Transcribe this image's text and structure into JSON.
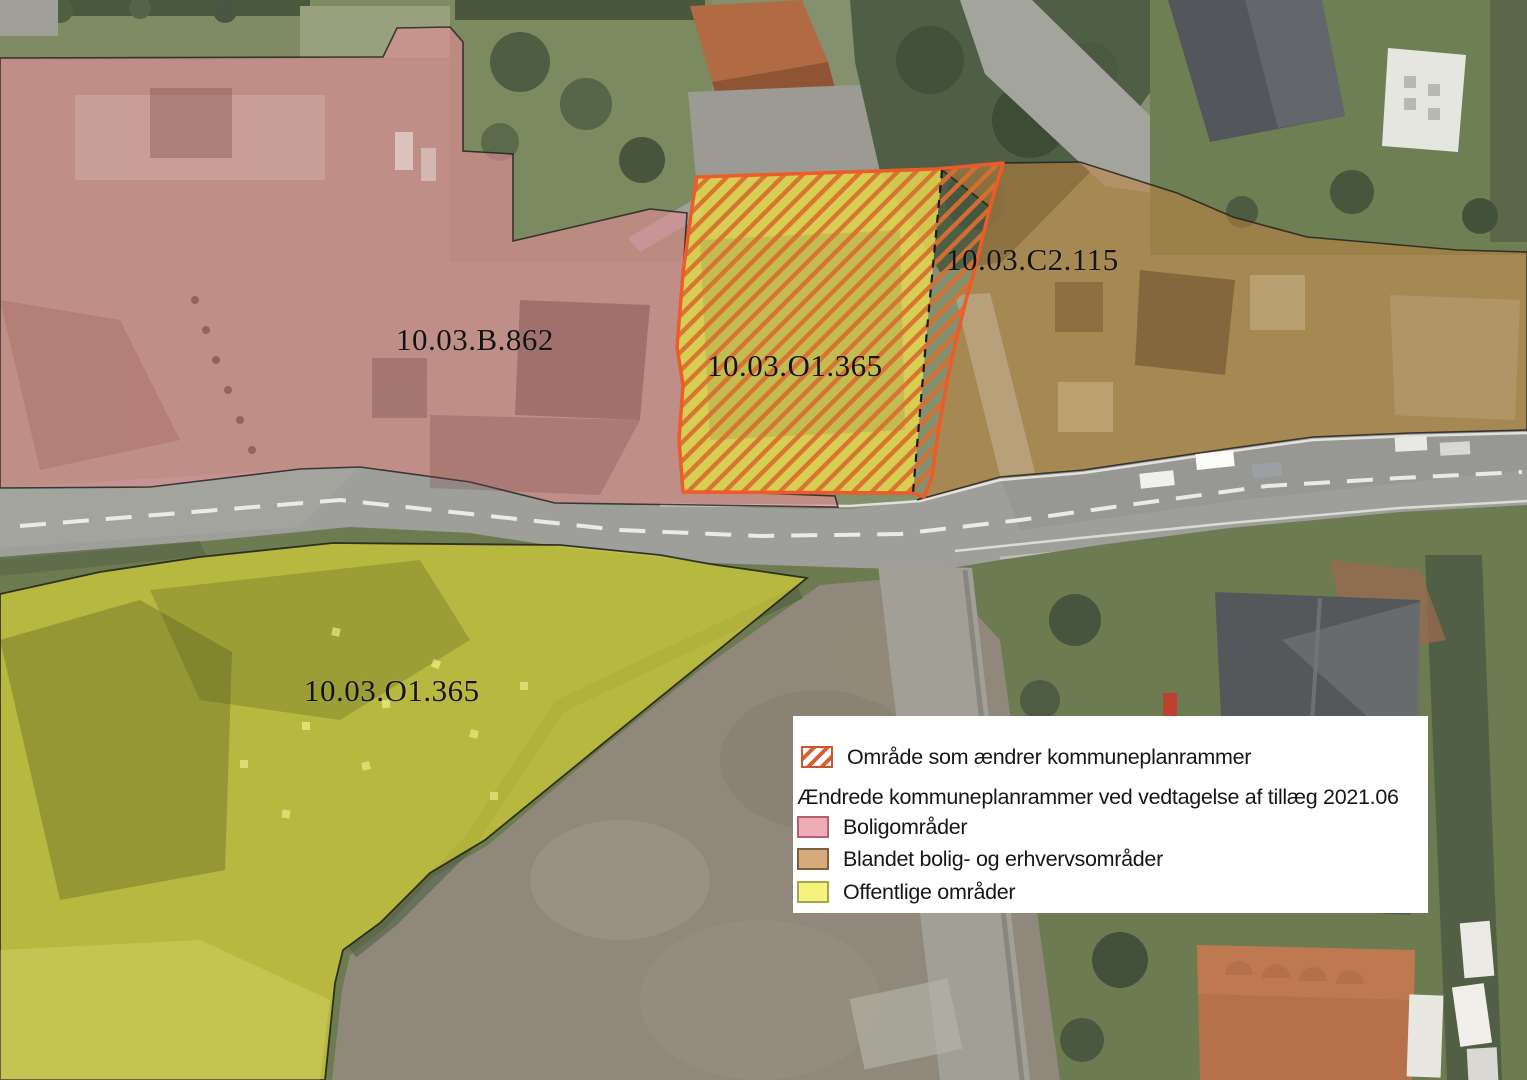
{
  "map_labels": {
    "zone_residential": "10.03.B.862",
    "zone_changed": "10.03.O1.365",
    "zone_mixed": "10.03.C2.115",
    "zone_public": "10.03.O1.365"
  },
  "legend": {
    "changed_area_label": "Område som ændrer kommuneplanrammer",
    "subtitle": "Ændrede kommuneplanrammer ved vedtagelse af tillæg 2021.06",
    "items": [
      {
        "label": "Boligområder",
        "fill": "#efacb6",
        "border": "#b4606d"
      },
      {
        "label": "Blandet bolig- og erhvervsområder",
        "fill": "#d6aa7b",
        "border": "#7e5f3c"
      },
      {
        "label": "Offentlige områder",
        "fill": "#f5f27d",
        "border": "#a8a54e"
      }
    ]
  },
  "zone_colors": {
    "residential_fill": "rgba(226,140,150,0.62)",
    "mixed_fill": "rgba(193,130,62,0.55)",
    "public_fill": "rgba(222,216,54,0.66)",
    "changed_area_fill": "rgba(228,219,80,0.85)",
    "hatch_stripe": "#d96e2f",
    "hatch_border": "#ec5b28",
    "zone_outline": "#1d1d1d"
  }
}
